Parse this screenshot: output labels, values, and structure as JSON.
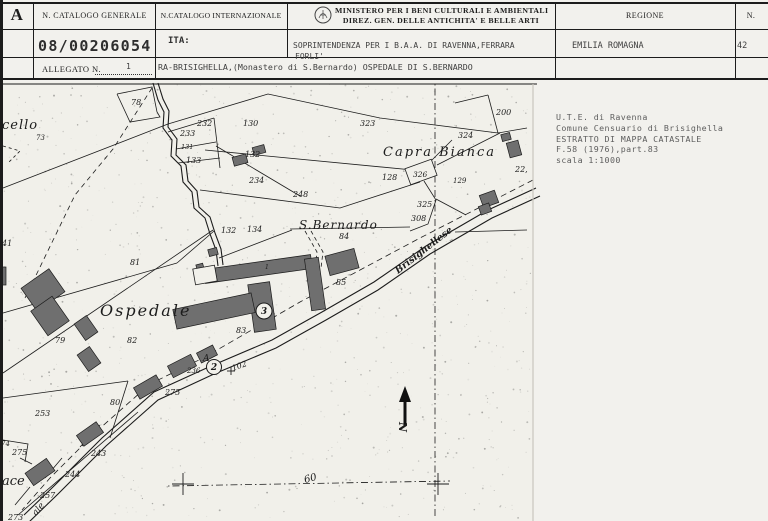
{
  "header": {
    "corner_letter": "A",
    "col1_label": "N. CATALOGO GENERALE",
    "col2_label": "N.CATALOGO INTERNAZIONALE",
    "ministry_line1": "MINISTERO PER I BENI CULTURALI E AMBIENTALI",
    "ministry_line2": "DIREZ. GEN. DELLE ANTICHITA' E BELLE ARTI",
    "regione_label": "REGIONE",
    "n_label": "N.",
    "catalog_number": "08/00206054",
    "ita_label": "ITA:",
    "soprintendenza_line1": "SOPRINTENDENZA PER I B.A.A. DI RAVENNA,FERRARA",
    "soprintendenza_line2": "FORLI'",
    "regione_value": "EMILIA ROMAGNA",
    "n_value": "42",
    "allegato_label": "ALLEGATO N.",
    "allegato_value": "1",
    "object_title": "RA-BRISIGHELLA,(Monastero di S.Bernardo) OSPEDALE DI S.BERNARDO"
  },
  "side_note": {
    "lines": [
      "U.T.E. di Ravenna",
      "Comune Censuario di Brisighella",
      "ESTRATTO DI MAPPA CATASTALE",
      "F.58 (1976),part.83",
      "scala 1:1000"
    ]
  },
  "map": {
    "ink": "#1c1c1c",
    "paper": "#f1f0ea",
    "building_fill": "#6f6f6f",
    "speckle_count": 1000,
    "labels": [
      {
        "t": "cello",
        "x": 2,
        "y": 129,
        "s": 13,
        "ls": 1
      },
      {
        "t": "73",
        "x": 36,
        "y": 140,
        "s": 7
      },
      {
        "t": "78",
        "x": 131,
        "y": 105,
        "s": 8
      },
      {
        "t": "232",
        "x": 197,
        "y": 126,
        "s": 8
      },
      {
        "t": "233",
        "x": 180,
        "y": 136,
        "s": 8
      },
      {
        "t": "131",
        "x": 181,
        "y": 149,
        "s": 6.5
      },
      {
        "t": "133",
        "x": 186,
        "y": 163,
        "s": 8
      },
      {
        "t": "130",
        "x": 243,
        "y": 126,
        "s": 8
      },
      {
        "t": "132",
        "x": 245,
        "y": 157,
        "s": 8
      },
      {
        "t": "234",
        "x": 249,
        "y": 183,
        "s": 8
      },
      {
        "t": "248",
        "x": 293,
        "y": 197,
        "s": 8
      },
      {
        "t": "323",
        "x": 360,
        "y": 126,
        "s": 8
      },
      {
        "t": "Capra Bianca",
        "x": 383,
        "y": 156,
        "s": 13,
        "ls": 2
      },
      {
        "t": "324",
        "x": 458,
        "y": 138,
        "s": 8
      },
      {
        "t": "200",
        "x": 496,
        "y": 115,
        "s": 8
      },
      {
        "t": "128",
        "x": 382,
        "y": 180,
        "s": 8
      },
      {
        "t": "326",
        "x": 413,
        "y": 177,
        "s": 7.5
      },
      {
        "t": "129",
        "x": 453,
        "y": 183,
        "s": 7
      },
      {
        "t": "22,",
        "x": 515,
        "y": 172,
        "s": 8
      },
      {
        "t": "325",
        "x": 417,
        "y": 207,
        "s": 8
      },
      {
        "t": "308",
        "x": 411,
        "y": 221,
        "s": 8
      },
      {
        "t": "S.Bernardo",
        "x": 299,
        "y": 229,
        "s": 12,
        "ls": 1
      },
      {
        "t": "84",
        "x": 339,
        "y": 239,
        "s": 8
      },
      {
        "t": "85",
        "x": 336,
        "y": 285,
        "s": 8
      },
      {
        "t": "134",
        "x": 247,
        "y": 232,
        "s": 8
      },
      {
        "t": "132",
        "x": 221,
        "y": 233,
        "s": 8
      },
      {
        "t": "41",
        "x": 2,
        "y": 246,
        "s": 8
      },
      {
        "t": "81",
        "x": 130,
        "y": 265,
        "s": 8
      },
      {
        "t": "1",
        "x": 265,
        "y": 269,
        "s": 6
      },
      {
        "t": "Ospedale",
        "x": 100,
        "y": 316,
        "s": 16,
        "ls": 2
      },
      {
        "t": "79",
        "x": 55,
        "y": 343,
        "s": 8
      },
      {
        "t": "82",
        "x": 127,
        "y": 343,
        "s": 8
      },
      {
        "t": "83",
        "x": 236,
        "y": 333,
        "s": 8
      },
      {
        "t": "A",
        "x": 203,
        "y": 361,
        "s": 9
      },
      {
        "t": "236",
        "x": 187,
        "y": 373,
        "s": 7
      },
      {
        "t": "102",
        "x": 233,
        "y": 371,
        "s": 8,
        "r": -20
      },
      {
        "t": "253",
        "x": 35,
        "y": 416,
        "s": 8
      },
      {
        "t": "80",
        "x": 110,
        "y": 405,
        "s": 8
      },
      {
        "t": "275",
        "x": 165,
        "y": 395,
        "s": 8
      },
      {
        "t": "74",
        "x": 1,
        "y": 446,
        "s": 7
      },
      {
        "t": "275",
        "x": 12,
        "y": 455,
        "s": 8
      },
      {
        "t": "ace",
        "x": 2,
        "y": 485,
        "s": 13
      },
      {
        "t": "243",
        "x": 91,
        "y": 456,
        "s": 8
      },
      {
        "t": "244",
        "x": 65,
        "y": 477,
        "s": 8
      },
      {
        "t": "257",
        "x": 40,
        "y": 498,
        "s": 8
      },
      {
        "t": "273",
        "x": 8,
        "y": 520,
        "s": 8
      },
      {
        "t": "ale",
        "x": 36,
        "y": 516,
        "s": 9,
        "r": -50
      },
      {
        "t": "60",
        "x": 305,
        "y": 483,
        "s": 10,
        "r": -15
      },
      {
        "t": "Brisighellese",
        "x": 398,
        "y": 274,
        "s": 9.5,
        "r": -38,
        "b": 1
      },
      {
        "t": "N",
        "x": 399,
        "y": 427,
        "s": 11,
        "r": 90,
        "b": 1
      }
    ],
    "circled": [
      {
        "t": "2",
        "x": 214,
        "y": 367,
        "r": 7.5
      },
      {
        "t": "3",
        "x": 264,
        "y": 311,
        "r": 8
      }
    ],
    "crosses": [
      {
        "x": 183,
        "y": 484,
        "s": 11
      },
      {
        "x": 438,
        "y": 484,
        "s": 11
      },
      {
        "x": 231,
        "y": 371,
        "s": 4
      }
    ],
    "north_arrow": {
      "x": 405,
      "y_tip": 386,
      "y_base": 426
    },
    "roads": [
      {
        "pts": [
          [
            153,
            83
          ],
          [
            158,
            100
          ],
          [
            164,
            112
          ],
          [
            163,
            128
          ],
          [
            172,
            140
          ],
          [
            171,
            156
          ],
          [
            181,
            166
          ],
          [
            183,
            182
          ],
          [
            192,
            192
          ],
          [
            194,
            208
          ],
          [
            205,
            218
          ],
          [
            210,
            234
          ],
          [
            216,
            250
          ],
          [
            218,
            266
          ]
        ]
      },
      {
        "pts": [
          [
            158,
            83
          ],
          [
            163,
            99
          ],
          [
            169,
            111
          ],
          [
            168,
            127
          ],
          [
            177,
            139
          ],
          [
            176,
            155
          ],
          [
            186,
            165
          ],
          [
            188,
            181
          ],
          [
            197,
            191
          ],
          [
            199,
            207
          ],
          [
            210,
            217
          ],
          [
            215,
            233
          ],
          [
            221,
            249
          ],
          [
            223,
            265
          ]
        ]
      },
      {
        "pts": [
          [
            540,
            196
          ],
          [
            492,
            218
          ],
          [
            430,
            254
          ],
          [
            378,
            290
          ],
          [
            326,
            320
          ],
          [
            276,
            348
          ],
          [
            214,
            374
          ],
          [
            158,
            400
          ],
          [
            106,
            446
          ],
          [
            58,
            494
          ],
          [
            28,
            523
          ]
        ]
      },
      {
        "pts": [
          [
            536,
            188
          ],
          [
            488,
            210
          ],
          [
            426,
            246
          ],
          [
            374,
            282
          ],
          [
            322,
            312
          ],
          [
            272,
            340
          ],
          [
            211,
            366
          ],
          [
            154,
            392
          ],
          [
            102,
            438
          ],
          [
            54,
            486
          ],
          [
            24,
            515
          ]
        ]
      }
    ],
    "lines": [
      [
        [
          3,
          188
        ],
        [
          168,
          124
        ]
      ],
      [
        [
          3,
          373
        ],
        [
          213,
          230
        ]
      ],
      [
        [
          3,
          313
        ],
        [
          177,
          263
        ]
      ],
      [
        [
          177,
          263
        ],
        [
          214,
          231
        ]
      ],
      [
        [
          168,
          124
        ],
        [
          268,
          94
        ],
        [
          380,
          118
        ],
        [
          498,
          133
        ]
      ],
      [
        [
          498,
          133
        ],
        [
          527,
          128
        ]
      ],
      [
        [
          488,
          95
        ],
        [
          498,
          133
        ]
      ],
      [
        [
          455,
          103
        ],
        [
          488,
          95
        ]
      ],
      [
        [
          205,
          150
        ],
        [
          423,
          171
        ]
      ],
      [
        [
          437,
          165
        ],
        [
          500,
          133
        ]
      ],
      [
        [
          426,
          166
        ],
        [
          452,
          140
        ]
      ],
      [
        [
          200,
          190
        ],
        [
          340,
          208
        ],
        [
          420,
          182
        ]
      ],
      [
        [
          424,
          181
        ],
        [
          436,
          200
        ],
        [
          428,
          224
        ],
        [
          410,
          231
        ]
      ],
      [
        [
          436,
          199
        ],
        [
          466,
          215
        ]
      ],
      [
        [
          290,
          229
        ],
        [
          410,
          227
        ]
      ],
      [
        [
          219,
          258
        ],
        [
          292,
          230
        ]
      ],
      [
        [
          168,
          132
        ],
        [
          214,
          118
        ]
      ],
      [
        [
          214,
          118
        ],
        [
          220,
          168
        ]
      ],
      [
        [
          176,
          149
        ],
        [
          216,
          142
        ]
      ],
      [
        [
          178,
          163
        ],
        [
          220,
          158
        ]
      ],
      [
        [
          216,
          146
        ],
        [
          300,
          196
        ]
      ],
      [
        [
          117,
          94
        ],
        [
          152,
          87
        ],
        [
          157,
          112
        ],
        [
          160,
          117
        ],
        [
          130,
          122
        ],
        [
          117,
          94
        ]
      ],
      [
        [
          3,
          398
        ],
        [
          128,
          381
        ]
      ],
      [
        [
          128,
          381
        ],
        [
          110,
          438
        ]
      ],
      [
        [
          138,
          412
        ],
        [
          18,
          515
        ]
      ],
      [
        [
          100,
          425
        ],
        [
          80,
          447
        ]
      ],
      [
        [
          62,
          458
        ],
        [
          45,
          478
        ]
      ],
      [
        [
          30,
          487
        ],
        [
          15,
          505
        ]
      ],
      [
        [
          3,
          440
        ],
        [
          28,
          444
        ],
        [
          25,
          462
        ]
      ],
      [
        [
          20,
          458
        ],
        [
          32,
          464
        ]
      ],
      [
        [
          455,
          232
        ],
        [
          527,
          230
        ]
      ]
    ],
    "dashed": [
      {
        "pts": [
          [
            152,
            88
          ],
          [
            113,
            149
          ],
          [
            75,
            195
          ],
          [
            25,
            298
          ]
        ],
        "d": "5,4"
      },
      {
        "pts": [
          [
            533,
            180
          ],
          [
            420,
            238
          ],
          [
            300,
            302
          ],
          [
            205,
            357
          ],
          [
            150,
            384
          ],
          [
            98,
            430
          ],
          [
            50,
            478
          ],
          [
            22,
            510
          ]
        ],
        "d": "6,4"
      },
      {
        "pts": [
          [
            305,
            231
          ],
          [
            317,
            252
          ],
          [
            315,
            268
          ]
        ],
        "d": "4,3"
      },
      {
        "pts": [
          [
            311,
            231
          ],
          [
            323,
            252
          ],
          [
            321,
            268
          ]
        ],
        "d": "4,3"
      },
      {
        "pts": [
          [
            435,
            84
          ],
          [
            435,
            518
          ]
        ],
        "d": "1.5,3,7,3"
      },
      {
        "pts": [
          [
            168,
            486
          ],
          [
            450,
            481
          ]
        ],
        "d": "1.5,3,7,3"
      },
      {
        "pts": [
          [
            3,
            146
          ],
          [
            20,
            151
          ],
          [
            8,
            163
          ]
        ],
        "d": "3,3"
      }
    ],
    "buildings": [
      {
        "x": 43,
        "y": 290,
        "w": 34,
        "h": 28,
        "r": -35
      },
      {
        "x": 50,
        "y": 316,
        "w": 26,
        "h": 30,
        "r": -35
      },
      {
        "x": 86,
        "y": 328,
        "w": 15,
        "h": 20,
        "r": -35
      },
      {
        "x": 89,
        "y": 359,
        "w": 15,
        "h": 20,
        "r": -35
      },
      {
        "x": 2,
        "y": 276,
        "w": 8,
        "h": 18,
        "r": 0
      },
      {
        "x": 240,
        "y": 160,
        "w": 14,
        "h": 9,
        "r": -15
      },
      {
        "x": 259,
        "y": 150,
        "w": 12,
        "h": 8,
        "r": -15
      },
      {
        "x": 213,
        "y": 252,
        "w": 9,
        "h": 7,
        "r": -15
      },
      {
        "x": 200,
        "y": 267,
        "w": 7,
        "h": 6,
        "r": -15
      },
      {
        "x": 258,
        "y": 269,
        "w": 108,
        "h": 14,
        "r": -8
      },
      {
        "x": 315,
        "y": 284,
        "w": 14,
        "h": 52,
        "r": -8
      },
      {
        "x": 262,
        "y": 307,
        "w": 22,
        "h": 48,
        "r": -8
      },
      {
        "x": 214,
        "y": 311,
        "w": 80,
        "h": 20,
        "r": -12
      },
      {
        "x": 342,
        "y": 262,
        "w": 30,
        "h": 20,
        "r": -15
      },
      {
        "x": 489,
        "y": 199,
        "w": 16,
        "h": 13,
        "r": -20
      },
      {
        "x": 485,
        "y": 209,
        "w": 11,
        "h": 9,
        "r": -20
      },
      {
        "x": 506,
        "y": 137,
        "w": 9,
        "h": 7,
        "r": -15
      },
      {
        "x": 514,
        "y": 149,
        "w": 12,
        "h": 15,
        "r": -15
      },
      {
        "x": 148,
        "y": 387,
        "w": 26,
        "h": 13,
        "r": -30
      },
      {
        "x": 182,
        "y": 366,
        "w": 26,
        "h": 13,
        "r": -27
      },
      {
        "x": 207,
        "y": 354,
        "w": 18,
        "h": 11,
        "r": -27
      },
      {
        "x": 90,
        "y": 434,
        "w": 24,
        "h": 13,
        "r": -35
      },
      {
        "x": 40,
        "y": 472,
        "w": 26,
        "h": 15,
        "r": -35
      }
    ],
    "outline_rects": [
      {
        "x": 205,
        "y": 275,
        "w": 22,
        "h": 16,
        "r": -10
      },
      {
        "x": 421,
        "y": 172,
        "w": 28,
        "h": 17,
        "r": -20
      }
    ]
  }
}
